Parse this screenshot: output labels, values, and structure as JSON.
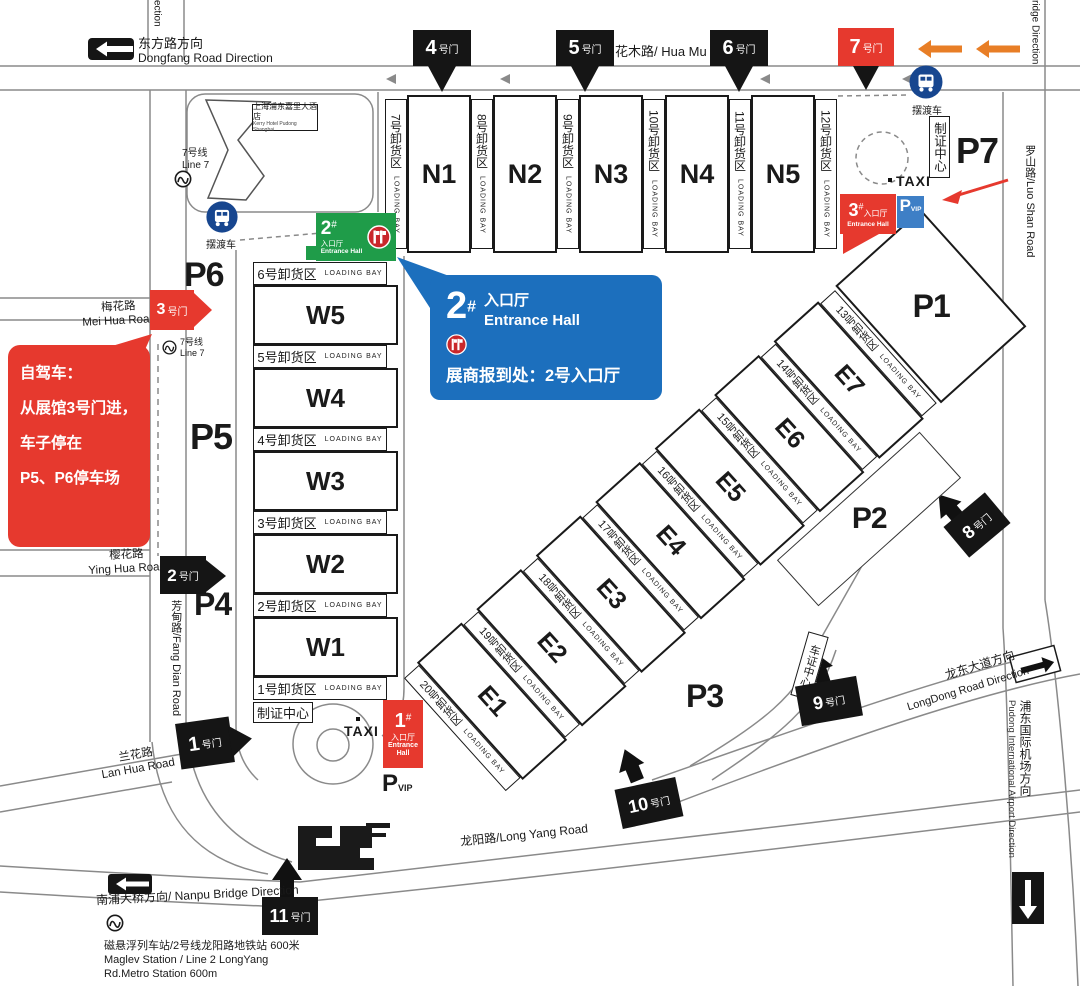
{
  "colors": {
    "red": "#E6392E",
    "green": "#1F9C49",
    "blue_callout": "#1C6FBD",
    "blue_vip": "#3E7FC6",
    "orange": "#E87E26",
    "gate_black": "#151515",
    "road_gray": "#8A8A8A"
  },
  "roads": {
    "dongfang_cn": "东方路方向",
    "dongfang_en": "Dongfang Road Direction",
    "huamu": "花木路/ Hua Mu Road",
    "meihua_cn": "梅花路",
    "meihua_en": "Mei Hua Road",
    "yinghua_cn": "樱花路",
    "yinghua_en": "Ying Hua Road",
    "fangdian": "芳甸路/Fang Dian Road",
    "lanhua_cn": "兰花路",
    "lanhua_en": "Lan Hua Road",
    "nanpu": "南浦大桥方向/ Nanpu Bridge Direction",
    "longyang": "龙阳路/Long Yang Road",
    "longdong_cn": "龙东大道方向",
    "longdong_en": "LongDong Road Direction",
    "airport_cn": "浦东国际机场方向",
    "airport_en": "Pudong International Airport Direction",
    "luoshan": "罗山路/Luo Shan Road",
    "partial_left": "ection",
    "partial_right": "ridge Direction"
  },
  "gates": {
    "suffix": "号门",
    "nums": {
      "g1": "1",
      "g2": "2",
      "g3": "3",
      "g4": "4",
      "g5": "5",
      "g6": "6",
      "g7": "7",
      "g8": "8",
      "g9": "9",
      "g10": "10",
      "g11": "11"
    }
  },
  "halls": {
    "north": [
      "N1",
      "N2",
      "N3",
      "N4",
      "N5"
    ],
    "west": [
      "W5",
      "W4",
      "W3",
      "W2",
      "W1"
    ],
    "east": [
      "E1",
      "E2",
      "E3",
      "E4",
      "E5",
      "E6",
      "E7"
    ]
  },
  "bays": {
    "suffix": "LOADING BAY",
    "north": [
      "7号卸货区",
      "8号卸货区",
      "9号卸货区",
      "10号卸货区",
      "11号卸货区",
      "12号卸货区"
    ],
    "west": [
      "6号卸货区",
      "5号卸货区",
      "4号卸货区",
      "3号卸货区",
      "2号卸货区",
      "1号卸货区"
    ],
    "east": [
      "20号卸货区",
      "19号卸货区",
      "18号卸货区",
      "17号卸货区",
      "16号卸货区",
      "15号卸货区",
      "14号卸货区",
      "13号卸货区"
    ]
  },
  "parking": {
    "p1": "P1",
    "p2": "P2",
    "p3": "P3",
    "p4": "P4",
    "p5": "P5",
    "p6": "P6",
    "p7": "P7"
  },
  "entrance": {
    "one": {
      "num": "1",
      "hash": "#",
      "cn": "入口厅",
      "en1": "Entrance",
      "en2": "Hall"
    },
    "two": {
      "num": "2",
      "hash": "#",
      "cn": "入口厅",
      "en": "Entrance Hall"
    },
    "three": {
      "num": "3",
      "hash": "#",
      "cn": "入口厅",
      "en": "Entrance Hall"
    }
  },
  "callout_blue": {
    "num": "2",
    "hash": "#",
    "cn": "入口厅",
    "en": "Entrance Hall",
    "note": "展商报到处：2号入口厅"
  },
  "callout_red": {
    "l1": "自驾车：",
    "l2": "从展馆3号门进，",
    "l3": "车子停在",
    "l4": "P5、P6停车场"
  },
  "facilities": {
    "zhizheng": "制证中心",
    "chezheng": "车证中心",
    "taxi": "TAXI",
    "p": "P",
    "vip": "VIP"
  },
  "transit": {
    "line7_cn": "7号线",
    "line7_en": "Line 7",
    "shuttle": "摆渡车",
    "maglev1": "磁悬浮列车站/2号线龙阳路地铁站  600米",
    "maglev2": "Maglev Station / Line 2 LongYang",
    "maglev3": "Rd.Metro Station 600m"
  },
  "hotel": {
    "cn": "上海浦东嘉里大酒店",
    "en": "Kerry Hotel Pudong Shanghai"
  }
}
